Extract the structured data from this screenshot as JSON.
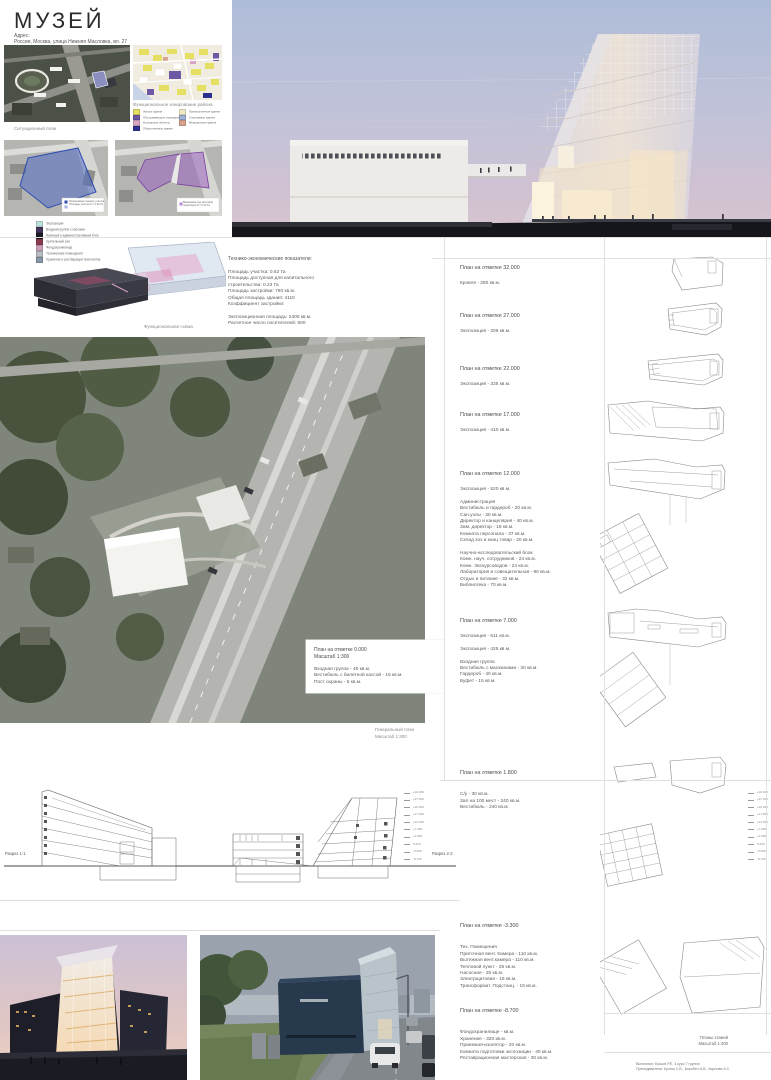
{
  "header": {
    "title": "МУЗЕЙ",
    "address_label": "Адрес:",
    "address": "Россия, Москва, улица Нижняя Масловка, вл. 27"
  },
  "top_left": {
    "situation_caption": "Ситуационный план",
    "zoning_caption": "Функциональное зонирование района",
    "zoning_legend": [
      {
        "label": "Жилые здания",
        "color": "#e5df63"
      },
      {
        "label": "Промышленные здания",
        "color": "#efe9c4"
      },
      {
        "label": "Обслуживающие учреждения",
        "color": "#6e59a5"
      },
      {
        "label": "Спортивные здания",
        "color": "#9fb3d8"
      },
      {
        "label": "Культурные объекты",
        "color": "#d9a7c4"
      },
      {
        "label": "Медицинские здания",
        "color": "#d8a48e"
      },
      {
        "label": "Общественные здания",
        "color": "#2b2f8e"
      }
    ],
    "site_map_a_legend": [
      "Нормативная граница участка",
      "Площадь участка S = 0.62 Га"
    ],
    "site_map_b_legend": [
      "Возможная под застройку",
      "территория S = 0.23 Га"
    ],
    "functional_legend": [
      {
        "label": "Экспозиция",
        "color": "#bfe0dd"
      },
      {
        "label": "Входная группа с кассами",
        "color": "#42355e"
      },
      {
        "label": "Научный и административный блок",
        "color": "#1d1d1f"
      },
      {
        "label": "Зрительный зал",
        "color": "#8c3a4d"
      },
      {
        "label": "Фондохранилище",
        "color": "#c9a0b8"
      },
      {
        "label": "Технические помещения",
        "color": "#b9bcc4"
      },
      {
        "label": "Хранение и реставрация экспонатов",
        "color": "#8a97a8"
      }
    ],
    "functional_caption": "Функциональная схема"
  },
  "indicators": {
    "title": "Технико-экономические показатели:",
    "lines": [
      "Площадь участка: 0.62 Га",
      "Площадь доступная для капитального",
      " строительства: 0.23 Га",
      "Площадь застройки: 780 кв.м.",
      "Общая площадь здания: 4110",
      "Коэффициент застройки:",
      "",
      "Экспозиционная площадь: 2400 кв.м.",
      "Расчетное число посетителей: 500"
    ]
  },
  "masterplan": {
    "note_title": "План на отметке 0.000",
    "note_scale": "Масштаб 1:300",
    "note_lines": [
      "Входная группа - 46 кв.м.",
      "Вестибюль с билетной кассой - 16 кв.м.",
      "Пост охраны - 5 кв.м."
    ],
    "caption_line1": "Генеральный план",
    "caption_line2": "Масштаб 1:300"
  },
  "plan_blocks": [
    {
      "title": "План на отметке 32.000",
      "lines": [
        "Кровля -  290 кв.м."
      ]
    },
    {
      "title": "План на отметке 27.000",
      "lines": [
        "Экспозиция - 206 кв.м."
      ]
    },
    {
      "title": "План на отметке 22.000",
      "lines": [
        "Экспозиция - 335 кв.м."
      ]
    },
    {
      "title": "План на отметке 17.000",
      "lines": [
        "Экспозиция - 410 кв.м."
      ]
    },
    {
      "title": "План на отметке 12.000",
      "lines": [
        "Экспозиция - 520 кв.м.",
        "",
        "Администрация",
        "Вестибюль и гардероб - 20 кв.м.",
        "Сан.узлы - 30 кв.м.",
        "Директор и канцелярия - 40 кв.м.",
        "Зам. директор - 18 кв.м.",
        "Комната персонала - 37 кв.м.",
        "Склад хоз и канц товар - 20 кв.м.",
        "",
        "Научно-исследовательский блок",
        "Комн. науч. сотрудников - 24 кв.м.",
        "Комн. Экскурсоводов - 24 кв.м.",
        "Лаборатория и совещательная - 90 кв.м.",
        "Отдых и питание - 32 кв.м.",
        "Библиотека  - 70 кв.м."
      ]
    },
    {
      "title": "План на отметке 7.000",
      "lines": [
        "Экспозиция - 511 кв.м.",
        "",
        "Экспозиция - 425 кв.м.",
        "",
        "Входная группа",
        "Вестибюль с магазинами - 30 кв.м.",
        "Гардероб - 40 кв.м.",
        "Буфет - 15 кв.м."
      ]
    },
    {
      "title": "План на отметке 1.800",
      "lines": [
        "",
        "С/у - 30 кв.м.",
        "Зал на 100 мест - 240 кв.м.",
        "Вестибюль - 240 кв.м."
      ]
    },
    {
      "title": "План на отметке -3.300",
      "lines": [
        "",
        "Тех. Помещения",
        "Приточная вент. Камера - 110 кв.м.",
        "Вытяжная вент.камера - 110 кв.м.",
        "Тепловой пункт - 25 кв.м.",
        "Насосная - 25 кв.м.",
        "Электрщитовая - 19 кв.м.",
        "Трансформат. Подстанц. - 15 кв.м."
      ]
    },
    {
      "title": "План на отметке -8.700",
      "lines": [
        "",
        "Фондохранилище -  кв.м.",
        "Хранение - 320 кв.м.",
        "Приемная-изолятор - 20 кв.м.",
        "Комната подготовки экспозиции - 40 кв.м.",
        "Реставрационная мастерская - 30 кв.м."
      ]
    }
  ],
  "sections": {
    "label_1": "Разрез 1-1",
    "label_2": "Разрез 2-2",
    "elevations": [
      "+32.000",
      "+27.000",
      "+22.000",
      "+17.000",
      "+12.000",
      "+7.000",
      "+1.800",
      "0.000",
      "-3.300",
      "-8.700"
    ]
  },
  "footer": {
    "plans_caption_line1": "Планы этажей",
    "plans_caption_line2": "Масштаб 1:400",
    "credit_line1": "Выполнил: Ершов Р.Е. 4 курс 7 группа",
    "credit_line2": "Преподаватели: Кулиш С.В., Бокобен А.В., Карпова А.С."
  }
}
